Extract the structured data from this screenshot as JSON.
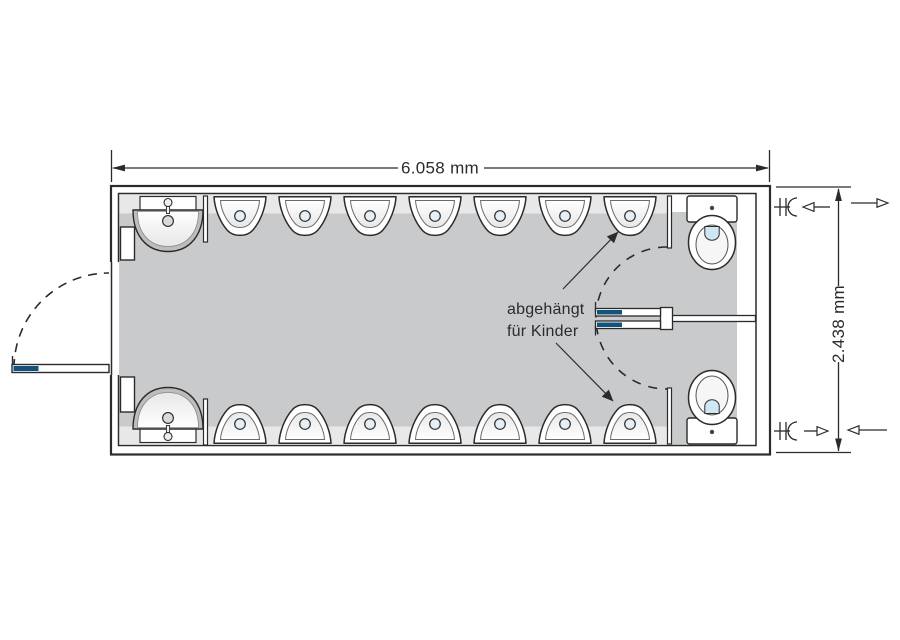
{
  "diagram": {
    "dimension_width_label": "6.058 mm",
    "dimension_height_label": "2.438 mm",
    "annotation_line1": "abgehängt",
    "annotation_line2": "für Kinder"
  },
  "fixtures": {
    "urinals_top_count": 7,
    "urinals_bottom_count": 7,
    "washbasins_count": 2,
    "toilets_count": 2
  },
  "colors": {
    "outline": "#2b2b2b",
    "floor_gray": "#c9cacb",
    "wall_band_gray": "#e8e8e8",
    "accent_blue": "#14527e",
    "flush_blue": "#cfe6f4"
  }
}
